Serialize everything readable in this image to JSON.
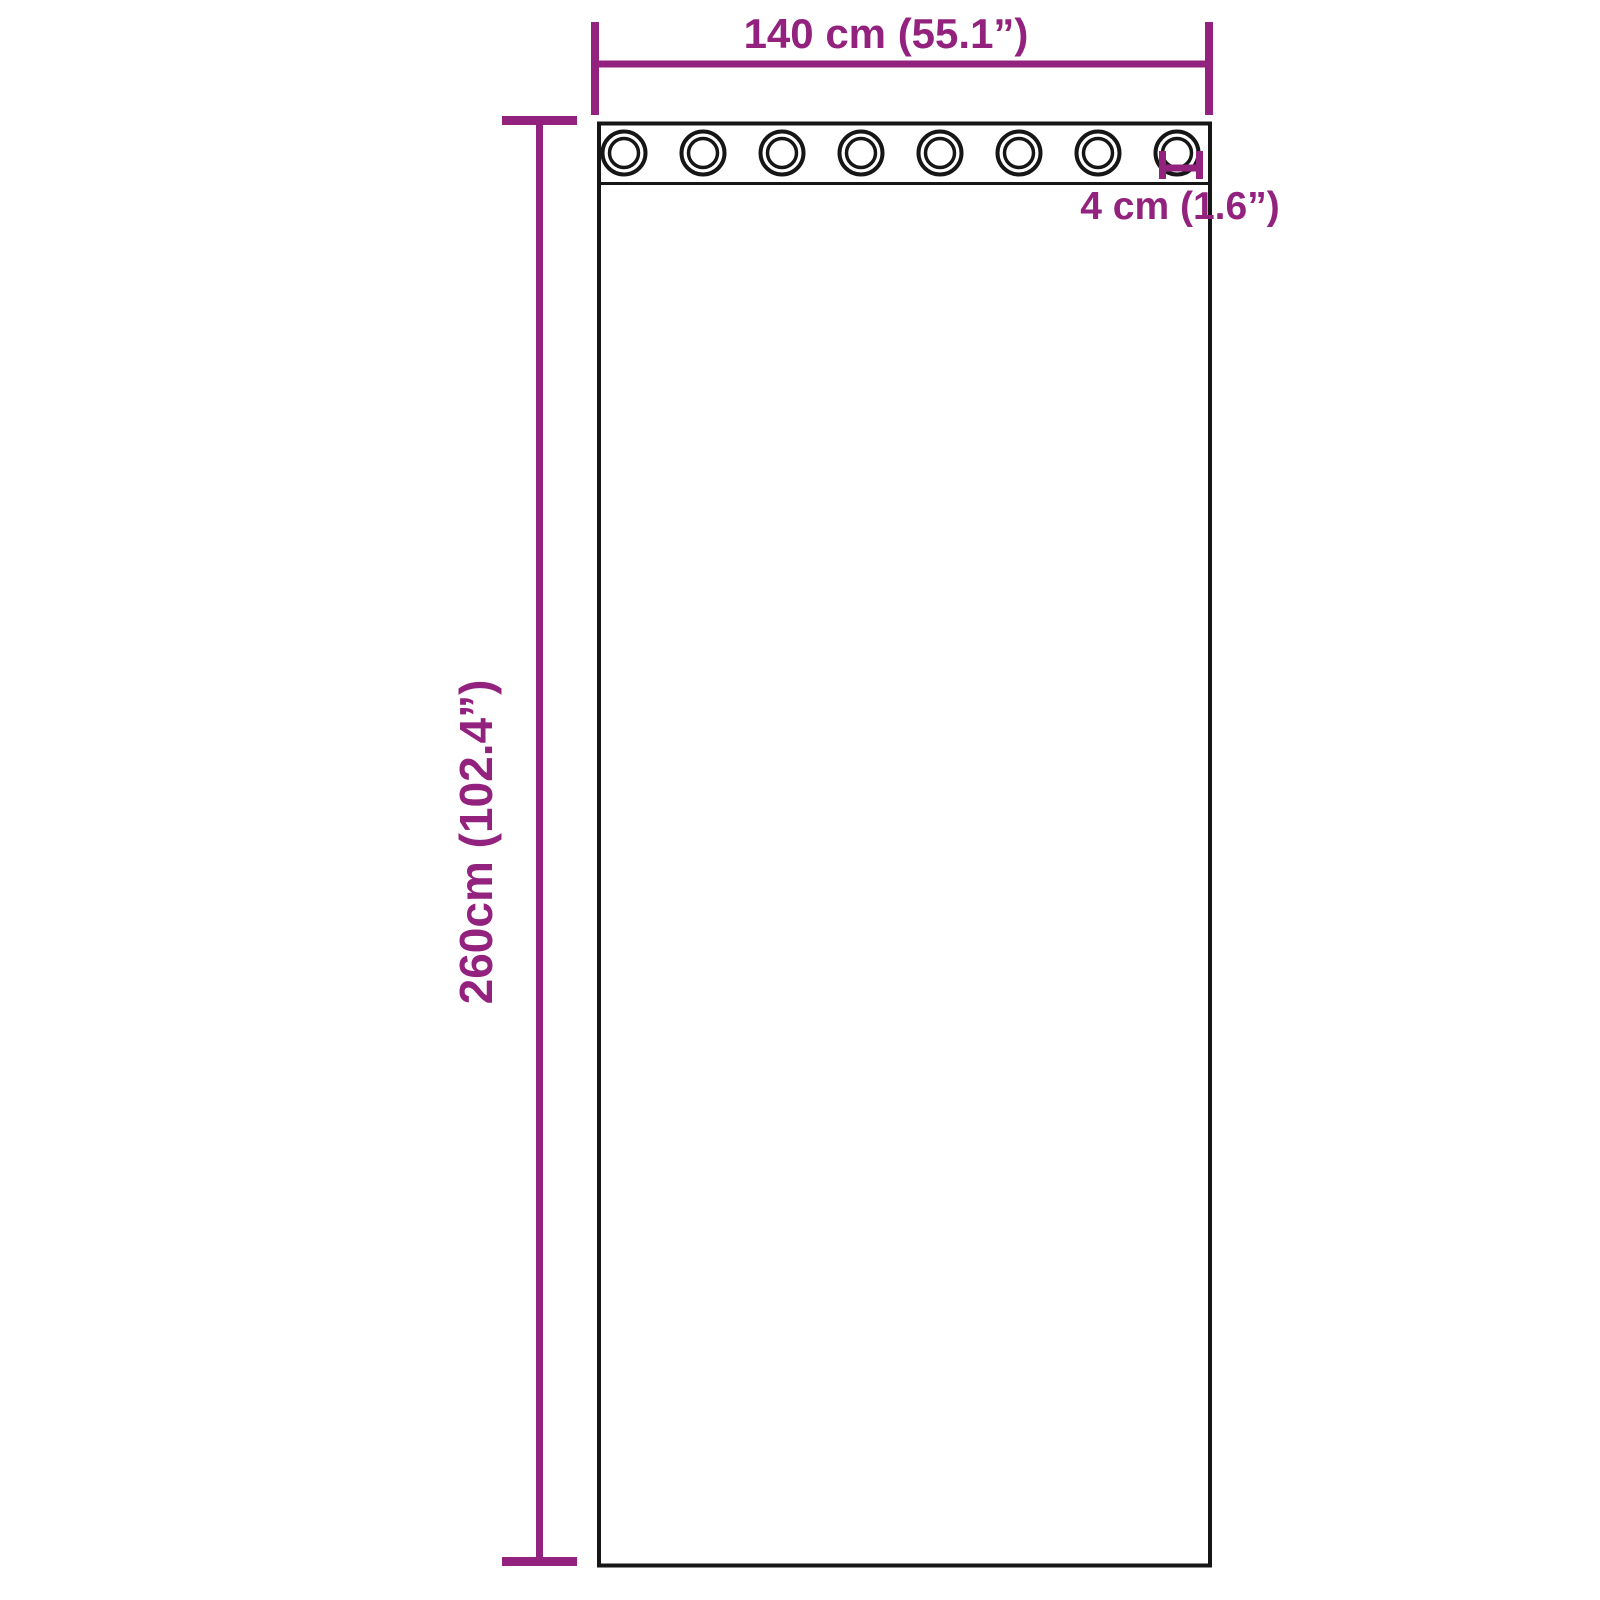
{
  "diagram": {
    "accent_color": "#93217e",
    "outline_color": "#161616",
    "background_color": "#ffffff",
    "grommet_count": 8,
    "labels": {
      "width": "140 cm (55.1”)",
      "height": "260cm (102.4”)",
      "grommet_diameter": "4 cm (1.6”)"
    }
  }
}
